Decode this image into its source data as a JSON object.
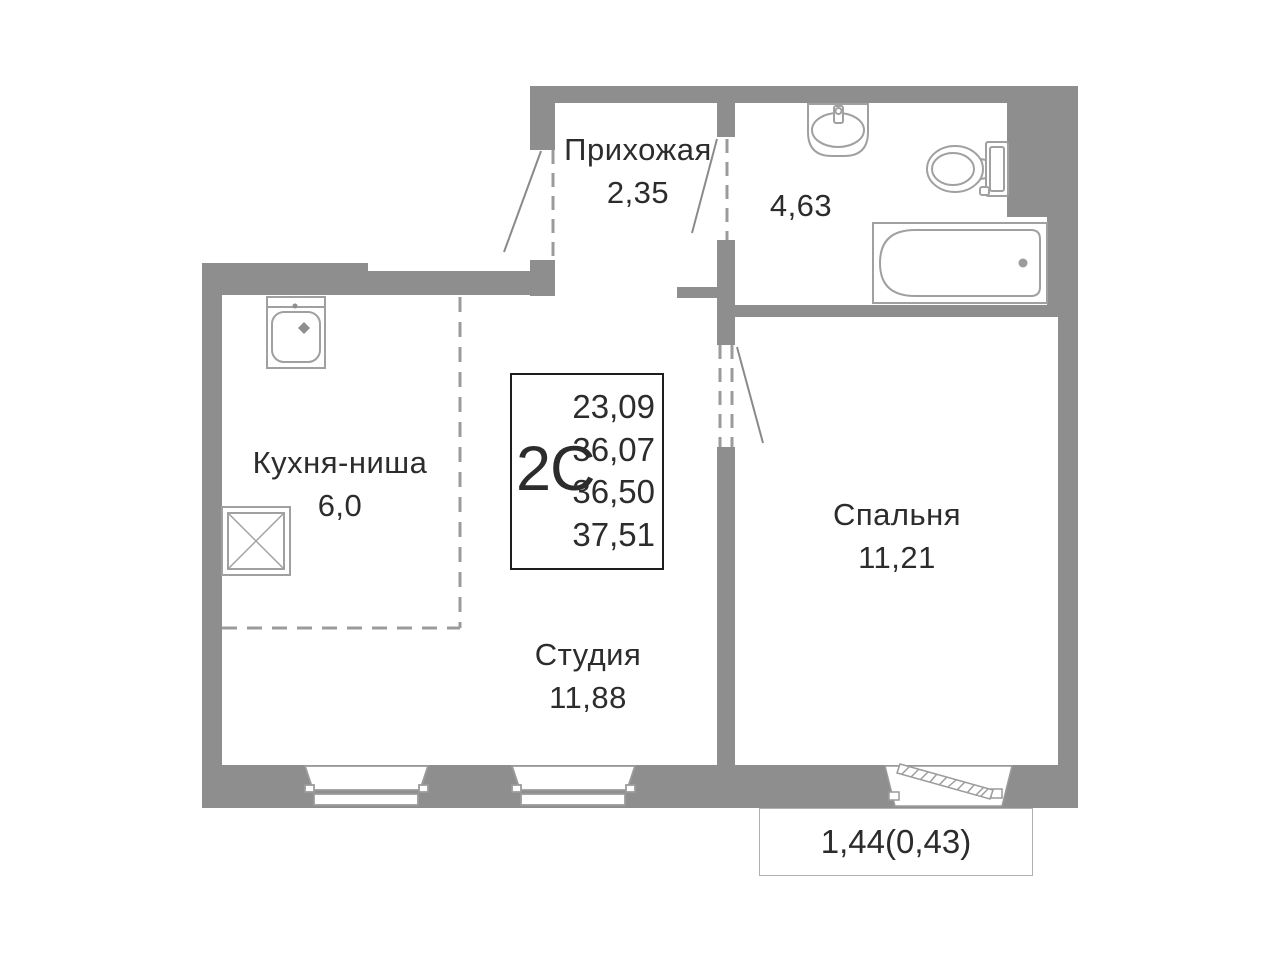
{
  "plan": {
    "title": "2С apartment floor plan",
    "rooms": {
      "hallway": {
        "name": "Прихожая",
        "area": "2,35"
      },
      "bathroom": {
        "area": "4,63"
      },
      "kitchen": {
        "name": "Кухня-ниша",
        "area": "6,0"
      },
      "studio": {
        "name": "Студия",
        "area": "11,88"
      },
      "bedroom": {
        "name": "Спальня",
        "area": "11,21"
      }
    },
    "info_box": {
      "type": "2С",
      "values": [
        "23,09",
        "36,07",
        "36,50",
        "37,51"
      ]
    },
    "balcony": {
      "label": "1,44(0,43)"
    },
    "fixtures": [
      "bath-sink",
      "toilet",
      "bathtub",
      "kitchen-sink",
      "stove"
    ],
    "colors": {
      "wall": "#8e8e8e",
      "fixture_stroke": "#a0a0a0",
      "dashed_line": "#9b9b9b",
      "text": "#2c2c2c",
      "info_border": "#1d1d1d"
    }
  }
}
